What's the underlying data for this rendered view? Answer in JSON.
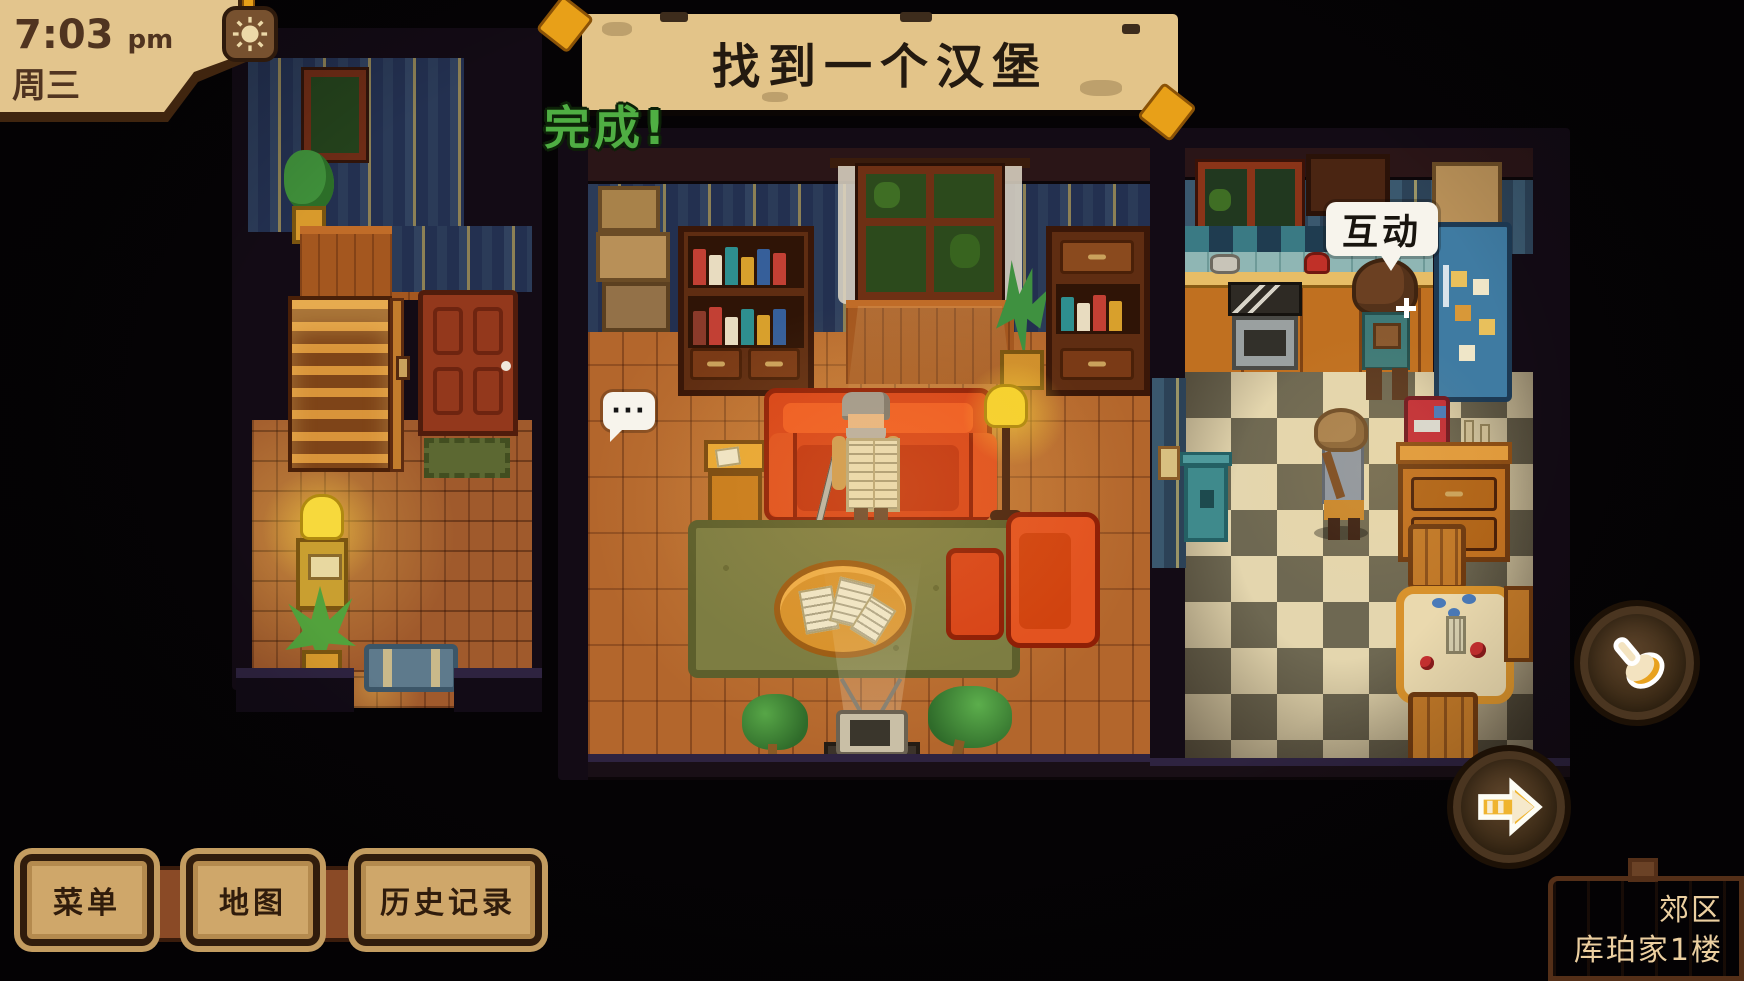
{
  "hud": {
    "clock": {
      "time": "7:03",
      "meridiem": "pm",
      "day": "周三"
    },
    "quest": {
      "title": "找到一个汉堡",
      "status": "完成!"
    },
    "interact_bubble": "互动",
    "speech_bubble": "···",
    "menu_buttons": [
      {
        "id": "menu",
        "label": "菜单"
      },
      {
        "id": "map",
        "label": "地图"
      },
      {
        "id": "history",
        "label": "历史记录"
      }
    ],
    "location": {
      "area": "郊区",
      "place": "库珀家1楼"
    }
  },
  "icons": {
    "sun": "sun-icon",
    "hand": "hand-cursor-icon",
    "arrow": "arrow-right-icon",
    "sparkle": "sparkle-icon"
  },
  "colors": {
    "paper": "#e3c58d",
    "banner": "#e3c489",
    "quest_done_green": "#4fae43",
    "button_fill": "#cfa76a",
    "sign_wood": "#8a5734",
    "bubble_white": "#f7f4ec",
    "accent_orange": "#e8a018"
  }
}
